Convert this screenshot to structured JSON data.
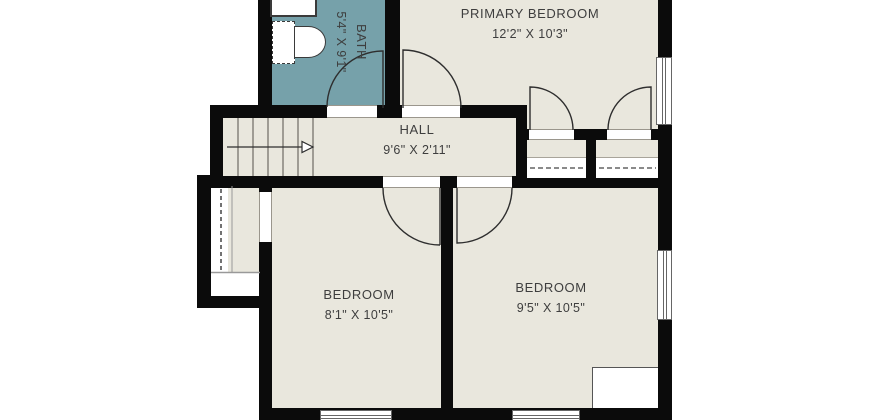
{
  "plan": {
    "title": "Second floor plan",
    "rooms": [
      {
        "id": "bath",
        "name": "BATH",
        "dims": "5'4\" X 9'1\""
      },
      {
        "id": "primary-bedroom",
        "name": "PRIMARY BEDROOM",
        "dims": "12'2\" X 10'3\""
      },
      {
        "id": "hall",
        "name": "HALL",
        "dims": "9'6\" X 2'11\""
      },
      {
        "id": "bedroom-left",
        "name": "BEDROOM",
        "dims": "8'1\" X 10'5\""
      },
      {
        "id": "bedroom-right",
        "name": "BEDROOM",
        "dims": "9'5\" X 10'5\""
      }
    ],
    "colors": {
      "background": "#ffffff",
      "wall": "#0b0b0b",
      "floor": "#e9e7dd",
      "bath_floor": "#76a1aa",
      "line": "#2e2e2e",
      "text": "#3e3e3e"
    }
  }
}
